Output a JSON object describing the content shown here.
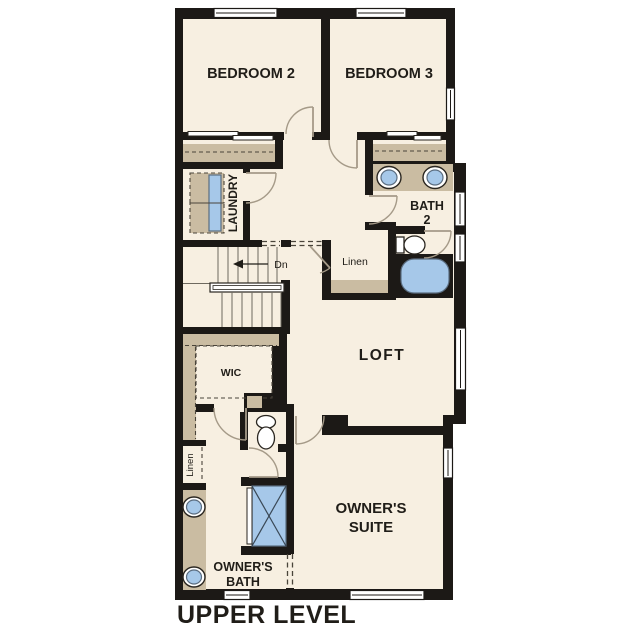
{
  "title": "UPPER LEVEL",
  "rooms": {
    "bedroom2": "BEDROOM 2",
    "bedroom3": "BEDROOM 3",
    "laundry": "LAUNDRY",
    "bath2_line1": "BATH",
    "bath2_line2": "2",
    "linen_upper": "Linen",
    "loft": "LOFT",
    "wic": "WIC",
    "owners_suite_line1": "OWNER'S",
    "owners_suite_line2": "SUITE",
    "owners_bath_line1": "OWNER'S",
    "owners_bath_line2": "BATH",
    "linen_lower": "Linen"
  },
  "stairs": {
    "direction_label": "Dn"
  },
  "colors": {
    "wall": "#1c1916",
    "floor": "#f7efe1",
    "shelf": "#cabca2",
    "fixture": "#a6c8e9",
    "arc": "#a59a88",
    "text": "#201d18"
  }
}
